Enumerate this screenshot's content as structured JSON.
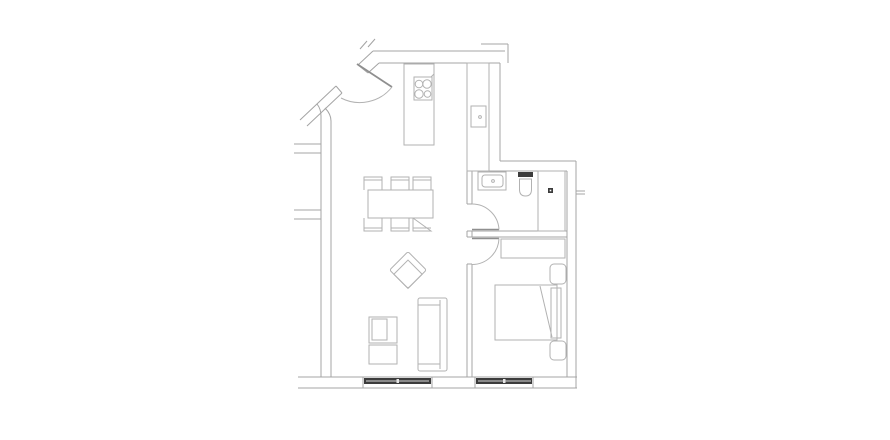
{
  "style": {
    "palette": {
      "wall": "#a4a4a4",
      "furniture": "#b2b2b2",
      "door": "#8f8f8f",
      "dark": "#3c3c3c",
      "light": "#d9d9d9",
      "white": "#ffffff",
      "background": "#ffffff"
    }
  },
  "floorplan": {
    "elements": [
      {
        "name": "wall-top-outer",
        "type": "line",
        "x1": 373,
        "y1": 51,
        "x2": 505,
        "y2": 51,
        "stroke": "wall"
      },
      {
        "name": "wall-top-inner",
        "type": "line",
        "x1": 379,
        "y1": 63,
        "x2": 500,
        "y2": 63,
        "stroke": "wall"
      },
      {
        "name": "wall-topright-stub-h",
        "type": "line",
        "x1": 481,
        "y1": 44,
        "x2": 508,
        "y2": 44,
        "stroke": "wall"
      },
      {
        "name": "wall-topright-stub-v",
        "type": "line",
        "x1": 508,
        "y1": 44,
        "x2": 508,
        "y2": 63,
        "stroke": "wall"
      },
      {
        "name": "wall-kitchen-right-inner",
        "type": "line",
        "x1": 489,
        "y1": 63,
        "x2": 489,
        "y2": 171,
        "stroke": "wall"
      },
      {
        "name": "wall-kitchen-right-outer",
        "type": "line",
        "x1": 500,
        "y1": 63,
        "x2": 500,
        "y2": 161,
        "stroke": "wall"
      },
      {
        "name": "wall-void-bottom",
        "type": "line",
        "x1": 500,
        "y1": 161,
        "x2": 576,
        "y2": 161,
        "stroke": "wall"
      },
      {
        "name": "wall-bath-top",
        "type": "line",
        "x1": 467,
        "y1": 171,
        "x2": 567,
        "y2": 171,
        "stroke": "wall"
      },
      {
        "name": "wall-right-inner",
        "type": "line",
        "x1": 567,
        "y1": 171,
        "x2": 567,
        "y2": 377,
        "stroke": "wall"
      },
      {
        "name": "wall-right-outer",
        "type": "line",
        "x1": 576,
        "y1": 161,
        "x2": 576,
        "y2": 388,
        "stroke": "wall"
      },
      {
        "name": "wall-right-stub-a",
        "type": "line",
        "x1": 576,
        "y1": 191,
        "x2": 585,
        "y2": 191,
        "stroke": "wall"
      },
      {
        "name": "wall-right-stub-b",
        "type": "line",
        "x1": 576,
        "y1": 194,
        "x2": 585,
        "y2": 194,
        "stroke": "wall"
      },
      {
        "name": "wall-bottom-inner",
        "type": "line",
        "x1": 298,
        "y1": 377,
        "x2": 577,
        "y2": 377,
        "stroke": "wall"
      },
      {
        "name": "wall-bottom-outer",
        "type": "line",
        "x1": 298,
        "y1": 388,
        "x2": 577,
        "y2": 388,
        "stroke": "wall"
      },
      {
        "name": "wall-left-outer",
        "type": "path",
        "d": "M 317 104 Q 321 109 321 116 L 321 377",
        "stroke": "wall"
      },
      {
        "name": "wall-left-inner",
        "type": "path",
        "d": "M 325 108 Q 331 114 331 121 L 331 377",
        "stroke": "wall"
      },
      {
        "name": "wall-left-stub-1a",
        "type": "line",
        "x1": 294,
        "y1": 144,
        "x2": 321,
        "y2": 144,
        "stroke": "wall"
      },
      {
        "name": "wall-left-stub-1b",
        "type": "line",
        "x1": 294,
        "y1": 153,
        "x2": 321,
        "y2": 153,
        "stroke": "wall"
      },
      {
        "name": "wall-left-stub-2a",
        "type": "line",
        "x1": 294,
        "y1": 210,
        "x2": 321,
        "y2": 210,
        "stroke": "wall"
      },
      {
        "name": "wall-left-stub-2b",
        "type": "line",
        "x1": 294,
        "y1": 219,
        "x2": 321,
        "y2": 219,
        "stroke": "wall"
      },
      {
        "name": "wall-entry-upper-outer",
        "type": "line",
        "x1": 373,
        "y1": 51,
        "x2": 358,
        "y2": 65,
        "stroke": "wall"
      },
      {
        "name": "wall-entry-upper-inner",
        "type": "line",
        "x1": 379,
        "y1": 63,
        "x2": 368,
        "y2": 73,
        "stroke": "wall"
      },
      {
        "name": "wall-entry-upper-jamb",
        "type": "line",
        "x1": 358,
        "y1": 65,
        "x2": 368,
        "y2": 73,
        "stroke": "wall"
      },
      {
        "name": "wall-entry-lower-outer",
        "type": "line",
        "x1": 336,
        "y1": 86,
        "x2": 300,
        "y2": 120,
        "stroke": "wall"
      },
      {
        "name": "wall-entry-lower-inner",
        "type": "line",
        "x1": 342,
        "y1": 93,
        "x2": 307,
        "y2": 126,
        "stroke": "wall"
      },
      {
        "name": "wall-entry-lower-jamb",
        "type": "line",
        "x1": 336,
        "y1": 86,
        "x2": 342,
        "y2": 93,
        "stroke": "wall"
      },
      {
        "name": "wall-cut-mark-1",
        "type": "line",
        "x1": 360,
        "y1": 49,
        "x2": 367,
        "y2": 41,
        "stroke": "wall"
      },
      {
        "name": "wall-cut-mark-2",
        "type": "line",
        "x1": 368,
        "y1": 47,
        "x2": 375,
        "y2": 39,
        "stroke": "wall"
      },
      {
        "name": "wall-divider-left",
        "type": "path",
        "d": "M 467 171 L 467 204 M 467 231 L 467 237 M 467 264 L 467 377",
        "stroke": "wall"
      },
      {
        "name": "wall-divider-right",
        "type": "path",
        "d": "M 472 171 L 472 204 M 472 231 L 472 237 M 472 264 L 472 377",
        "stroke": "wall"
      },
      {
        "name": "wall-divider-jambs",
        "type": "path",
        "d": "M 467 204 L 472 204 M 467 231 L 472 231 M 467 237 L 472 237 M 467 264 L 472 264",
        "stroke": "wall"
      },
      {
        "name": "wall-bathbed-top",
        "type": "line",
        "x1": 472,
        "y1": 231,
        "x2": 567,
        "y2": 231,
        "stroke": "wall"
      },
      {
        "name": "wall-bathbed-bottom",
        "type": "line",
        "x1": 472,
        "y1": 237,
        "x2": 567,
        "y2": 237,
        "stroke": "wall"
      },
      {
        "name": "entry-door-leaf",
        "type": "line",
        "x1": 357,
        "y1": 64,
        "x2": 392,
        "y2": 87,
        "stroke": "door",
        "sw": 1.8
      },
      {
        "name": "entry-door-arc",
        "type": "path",
        "d": "M 392 87 A 41 41 0 0 1 341 98",
        "stroke": "furniture"
      },
      {
        "name": "bathroom-door-leaf",
        "type": "line",
        "x1": 472,
        "y1": 229.5,
        "x2": 499,
        "y2": 229.5,
        "stroke": "door",
        "sw": 1.5
      },
      {
        "name": "bathroom-door-arc",
        "type": "path",
        "d": "M 499 229.5 A 27 27 0 0 0 472 204",
        "stroke": "furniture"
      },
      {
        "name": "bedroom-door-leaf",
        "type": "line",
        "x1": 472,
        "y1": 238.5,
        "x2": 499,
        "y2": 238.5,
        "stroke": "door",
        "sw": 1.5
      },
      {
        "name": "bedroom-door-arc",
        "type": "path",
        "d": "M 499 238.5 A 27 27 0 0 1 472 264.5",
        "stroke": "furniture"
      },
      {
        "name": "living-window-jamb-left",
        "type": "line",
        "x1": 363,
        "y1": 377,
        "x2": 363,
        "y2": 388,
        "stroke": "wall"
      },
      {
        "name": "living-window-jamb-right",
        "type": "line",
        "x1": 432,
        "y1": 377,
        "x2": 432,
        "y2": 388,
        "stroke": "wall"
      },
      {
        "name": "living-window-bar",
        "type": "rect",
        "x": 364,
        "y": 378,
        "w": 67,
        "h": 6,
        "fill": "dark",
        "stroke": "none"
      },
      {
        "name": "living-window-glass-line",
        "type": "line",
        "x1": 366,
        "y1": 381,
        "x2": 429,
        "y2": 381,
        "stroke": "light"
      },
      {
        "name": "living-window-mullion",
        "type": "rect",
        "x": 396.5,
        "y": 379,
        "w": 2.5,
        "h": 4,
        "fill": "#e6e6e6",
        "stroke": "none"
      },
      {
        "name": "bedroom-window-jamb-left",
        "type": "line",
        "x1": 475,
        "y1": 377,
        "x2": 475,
        "y2": 388,
        "stroke": "wall"
      },
      {
        "name": "bedroom-window-jamb-right",
        "type": "line",
        "x1": 533,
        "y1": 377,
        "x2": 533,
        "y2": 388,
        "stroke": "wall"
      },
      {
        "name": "bedroom-window-bar",
        "type": "rect",
        "x": 476,
        "y": 378,
        "w": 56,
        "h": 6,
        "fill": "dark",
        "stroke": "none"
      },
      {
        "name": "bedroom-window-glass-line",
        "type": "line",
        "x1": 478,
        "y1": 381,
        "x2": 531,
        "y2": 381,
        "stroke": "light"
      },
      {
        "name": "bedroom-window-mullion",
        "type": "rect",
        "x": 503,
        "y": 379,
        "w": 2.5,
        "h": 4,
        "fill": "#e6e6e6",
        "stroke": "none"
      },
      {
        "name": "kitchen-island",
        "type": "rect",
        "x": 404,
        "y": 64,
        "w": 30,
        "h": 81
      },
      {
        "name": "cooktop",
        "type": "rect",
        "x": 414,
        "y": 77,
        "w": 18,
        "h": 23
      },
      {
        "name": "cooktop-burner-1",
        "type": "circle",
        "cx": 419,
        "cy": 84,
        "r": 3.8
      },
      {
        "name": "cooktop-burner-2",
        "type": "circle",
        "cx": 427,
        "cy": 84,
        "r": 4.2
      },
      {
        "name": "cooktop-burner-3",
        "type": "circle",
        "cx": 419,
        "cy": 94,
        "r": 4.2
      },
      {
        "name": "cooktop-burner-4",
        "type": "circle",
        "cx": 427.5,
        "cy": 94,
        "r": 3.3
      },
      {
        "name": "cooktop-knob-mark",
        "type": "line",
        "x1": 431,
        "y1": 77,
        "x2": 434,
        "y2": 74
      },
      {
        "name": "kitchen-counter",
        "type": "rect",
        "x": 467,
        "y": 63,
        "w": 22,
        "h": 108
      },
      {
        "name": "kitchen-sink",
        "type": "rect",
        "x": 471,
        "y": 106,
        "w": 15,
        "h": 21
      },
      {
        "name": "kitchen-sink-drain-dot",
        "type": "circle",
        "cx": 480,
        "cy": 117,
        "r": 1.4
      },
      {
        "name": "bathroom-sink",
        "type": "rect",
        "x": 478,
        "y": 172,
        "w": 28,
        "h": 18
      },
      {
        "name": "bathroom-sink-basin",
        "type": "rect",
        "x": 482,
        "y": 175,
        "w": 21,
        "h": 12,
        "rx": 3
      },
      {
        "name": "bathroom-sink-faucet-dot",
        "type": "circle",
        "cx": 493,
        "cy": 181,
        "r": 1.4
      },
      {
        "name": "toilet-tank",
        "type": "rect",
        "x": 518,
        "y": 172,
        "w": 15,
        "h": 5,
        "fill": "dark",
        "stroke": "none"
      },
      {
        "name": "toilet-bowl",
        "type": "path",
        "d": "M 519.5 179 L 531.5 179 L 531.5 189.5 Q 531.5 196 525.5 196 Q 519.5 196 519.5 189.5 Z"
      },
      {
        "name": "shower",
        "type": "rect",
        "x": 538,
        "y": 171,
        "w": 27,
        "h": 60
      },
      {
        "name": "shower-drain",
        "type": "rect",
        "x": 548,
        "y": 188,
        "w": 5,
        "h": 5,
        "fill": "dark",
        "stroke": "none"
      },
      {
        "name": "shower-drain-dot",
        "type": "rect",
        "x": 549.7,
        "y": 189.7,
        "w": 1.6,
        "h": 1.6,
        "fill": "white",
        "stroke": "none"
      },
      {
        "name": "wardrobe",
        "type": "rect",
        "x": 501,
        "y": 239,
        "w": 64,
        "h": 19
      },
      {
        "name": "nightstand-top",
        "type": "rect",
        "x": 550,
        "y": 264,
        "w": 16,
        "h": 20,
        "rx": 4
      },
      {
        "name": "nightstand-bottom",
        "type": "rect",
        "x": 550,
        "y": 341,
        "w": 16,
        "h": 19,
        "rx": 4
      },
      {
        "name": "bed",
        "type": "rect",
        "x": 495,
        "y": 285,
        "w": 62,
        "h": 55
      },
      {
        "name": "bed-headboard",
        "type": "rect",
        "x": 551,
        "y": 288,
        "w": 10,
        "h": 50
      },
      {
        "name": "bed-fold-line",
        "type": "line",
        "x1": 540,
        "y1": 286,
        "x2": 552,
        "y2": 337
      },
      {
        "name": "dining-table",
        "type": "rect",
        "x": 368,
        "y": 190,
        "w": 65,
        "h": 28
      },
      {
        "name": "chair-top-1",
        "type": "path",
        "d": "M 364 190 L 364 177 L 382 177 L 382 190 M 364 180 L 382 180"
      },
      {
        "name": "chair-top-2",
        "type": "path",
        "d": "M 391 190 L 391 177 L 409 177 L 409 190 M 391 180 L 409 180"
      },
      {
        "name": "chair-top-3",
        "type": "path",
        "d": "M 413 190 L 413 177 L 431 177 L 431 190 M 413 180 L 431 180"
      },
      {
        "name": "chair-bottom-1",
        "type": "path",
        "d": "M 364 218 L 364 231 L 382 231 L 382 218 M 364 228 L 382 228"
      },
      {
        "name": "chair-bottom-2",
        "type": "path",
        "d": "M 391 218 L 391 231 L 409 231 L 409 218 M 391 228 L 409 228"
      },
      {
        "name": "chair-bottom-3",
        "type": "path",
        "d": "M 413 218 L 413 231 L 431 231 L 413 218 M 413 228 L 431 228"
      },
      {
        "name": "armchair",
        "type": "group",
        "transform": "translate(408 270) rotate(45)",
        "children": [
          {
            "name": "armchair-outer",
            "type": "rect",
            "x": -13,
            "y": -13,
            "w": 26,
            "h": 26,
            "rx": 2
          },
          {
            "name": "armchair-seat",
            "type": "rect",
            "x": -7,
            "y": -7,
            "w": 20,
            "h": 20
          }
        ]
      },
      {
        "name": "tv-stand-upper",
        "type": "rect",
        "x": 369,
        "y": 317,
        "w": 28,
        "h": 26
      },
      {
        "name": "tv-stand-upper-inner",
        "type": "rect",
        "x": 372,
        "y": 319,
        "w": 15,
        "h": 21
      },
      {
        "name": "tv-stand-lower",
        "type": "rect",
        "x": 369,
        "y": 345,
        "w": 28,
        "h": 19
      },
      {
        "name": "sofa",
        "type": "rect",
        "x": 418,
        "y": 298,
        "w": 29,
        "h": 73,
        "rx": 2
      },
      {
        "name": "sofa-backrest-line",
        "type": "line",
        "x1": 440,
        "y1": 300,
        "x2": 440,
        "y2": 369
      },
      {
        "name": "sofa-armrest-top",
        "type": "line",
        "x1": 418,
        "y1": 305,
        "x2": 440,
        "y2": 305
      },
      {
        "name": "sofa-armrest-bottom",
        "type": "line",
        "x1": 418,
        "y1": 364,
        "x2": 440,
        "y2": 364
      }
    ]
  }
}
